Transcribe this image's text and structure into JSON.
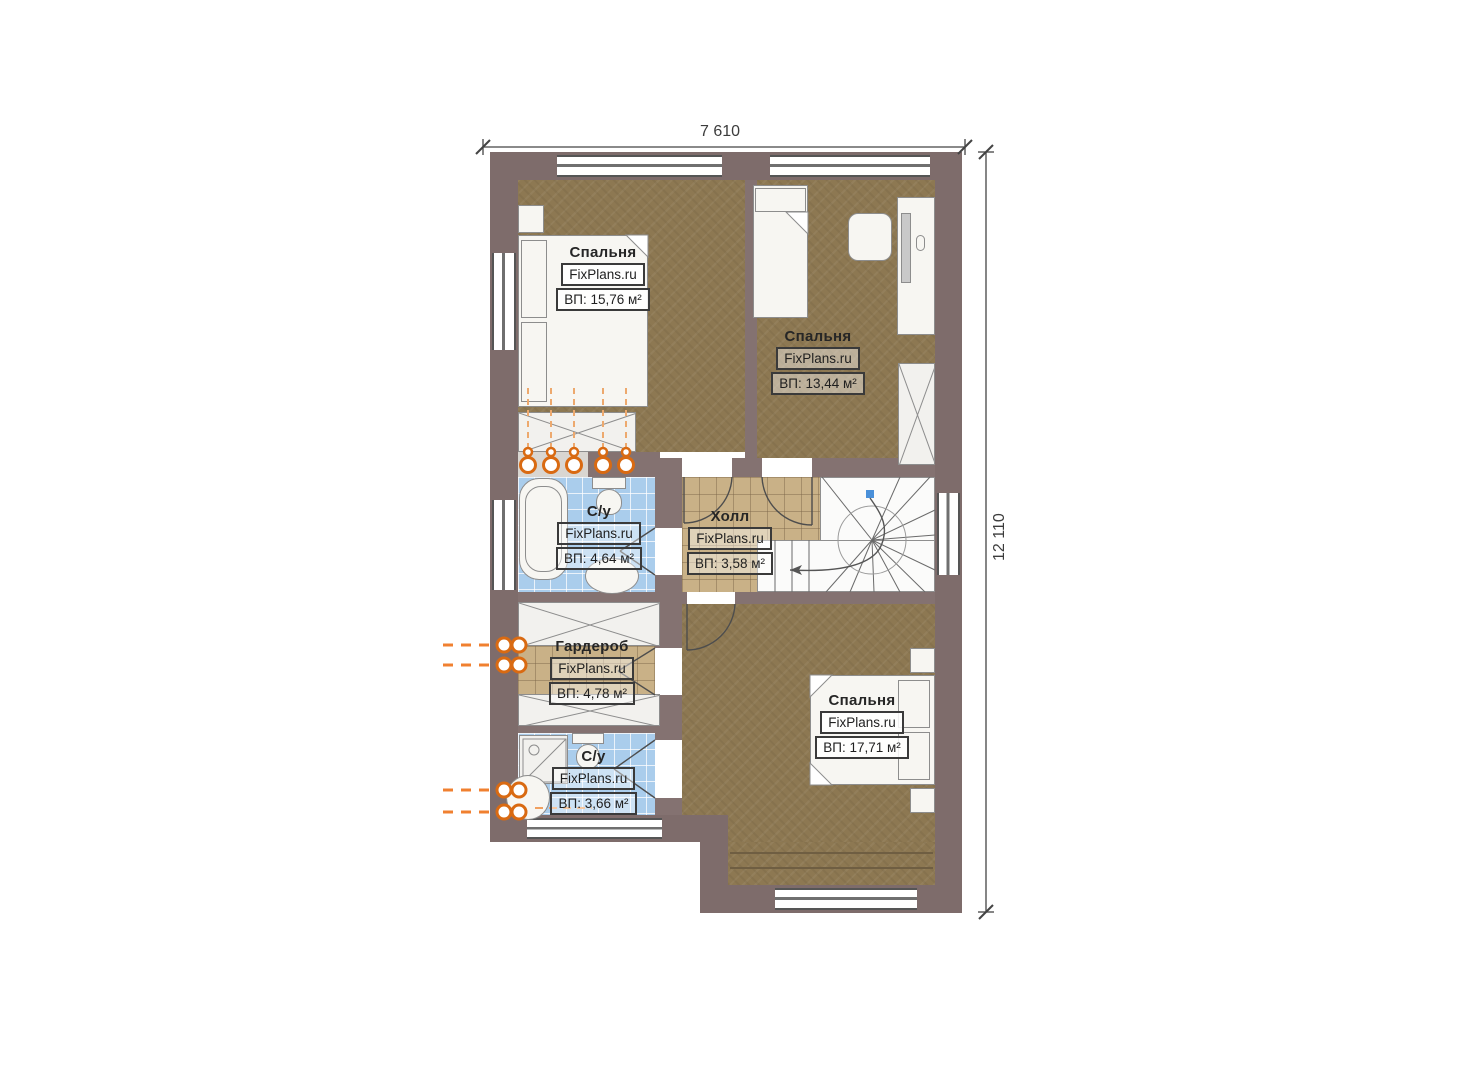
{
  "plan_title": "Floor plan (second floor)",
  "dimensions": {
    "width_top": "7 610",
    "height_right": "12 110"
  },
  "rooms": [
    {
      "id": "bedroom-1",
      "name": "Спальня",
      "brand": "FixPlans.ru",
      "area": "ВП: 15,76 м²"
    },
    {
      "id": "bedroom-2",
      "name": "Спальня",
      "brand": "FixPlans.ru",
      "area": "ВП: 13,44 м²"
    },
    {
      "id": "bathroom-1",
      "name": "С/у",
      "brand": "FixPlans.ru",
      "area": "ВП: 4,64 м²"
    },
    {
      "id": "hall",
      "name": "Холл",
      "brand": "FixPlans.ru",
      "area": "ВП: 3,58 м²"
    },
    {
      "id": "wardrobe",
      "name": "Гардероб",
      "brand": "FixPlans.ru",
      "area": "ВП: 4,78 м²"
    },
    {
      "id": "bathroom-2",
      "name": "С/у",
      "brand": "FixPlans.ru",
      "area": "ВП: 3,66 м²"
    },
    {
      "id": "bedroom-3",
      "name": "Спальня",
      "brand": "FixPlans.ru",
      "area": "ВП: 17,71 м²"
    }
  ],
  "colors": {
    "wall": "#7e6c6b",
    "bedroom_floor": "#8d7852",
    "hall_floor": "#c9b187",
    "bathroom_floor": "#aacdec",
    "pipe_accent": "#f07820",
    "stair_marker": "#4a90d9"
  }
}
